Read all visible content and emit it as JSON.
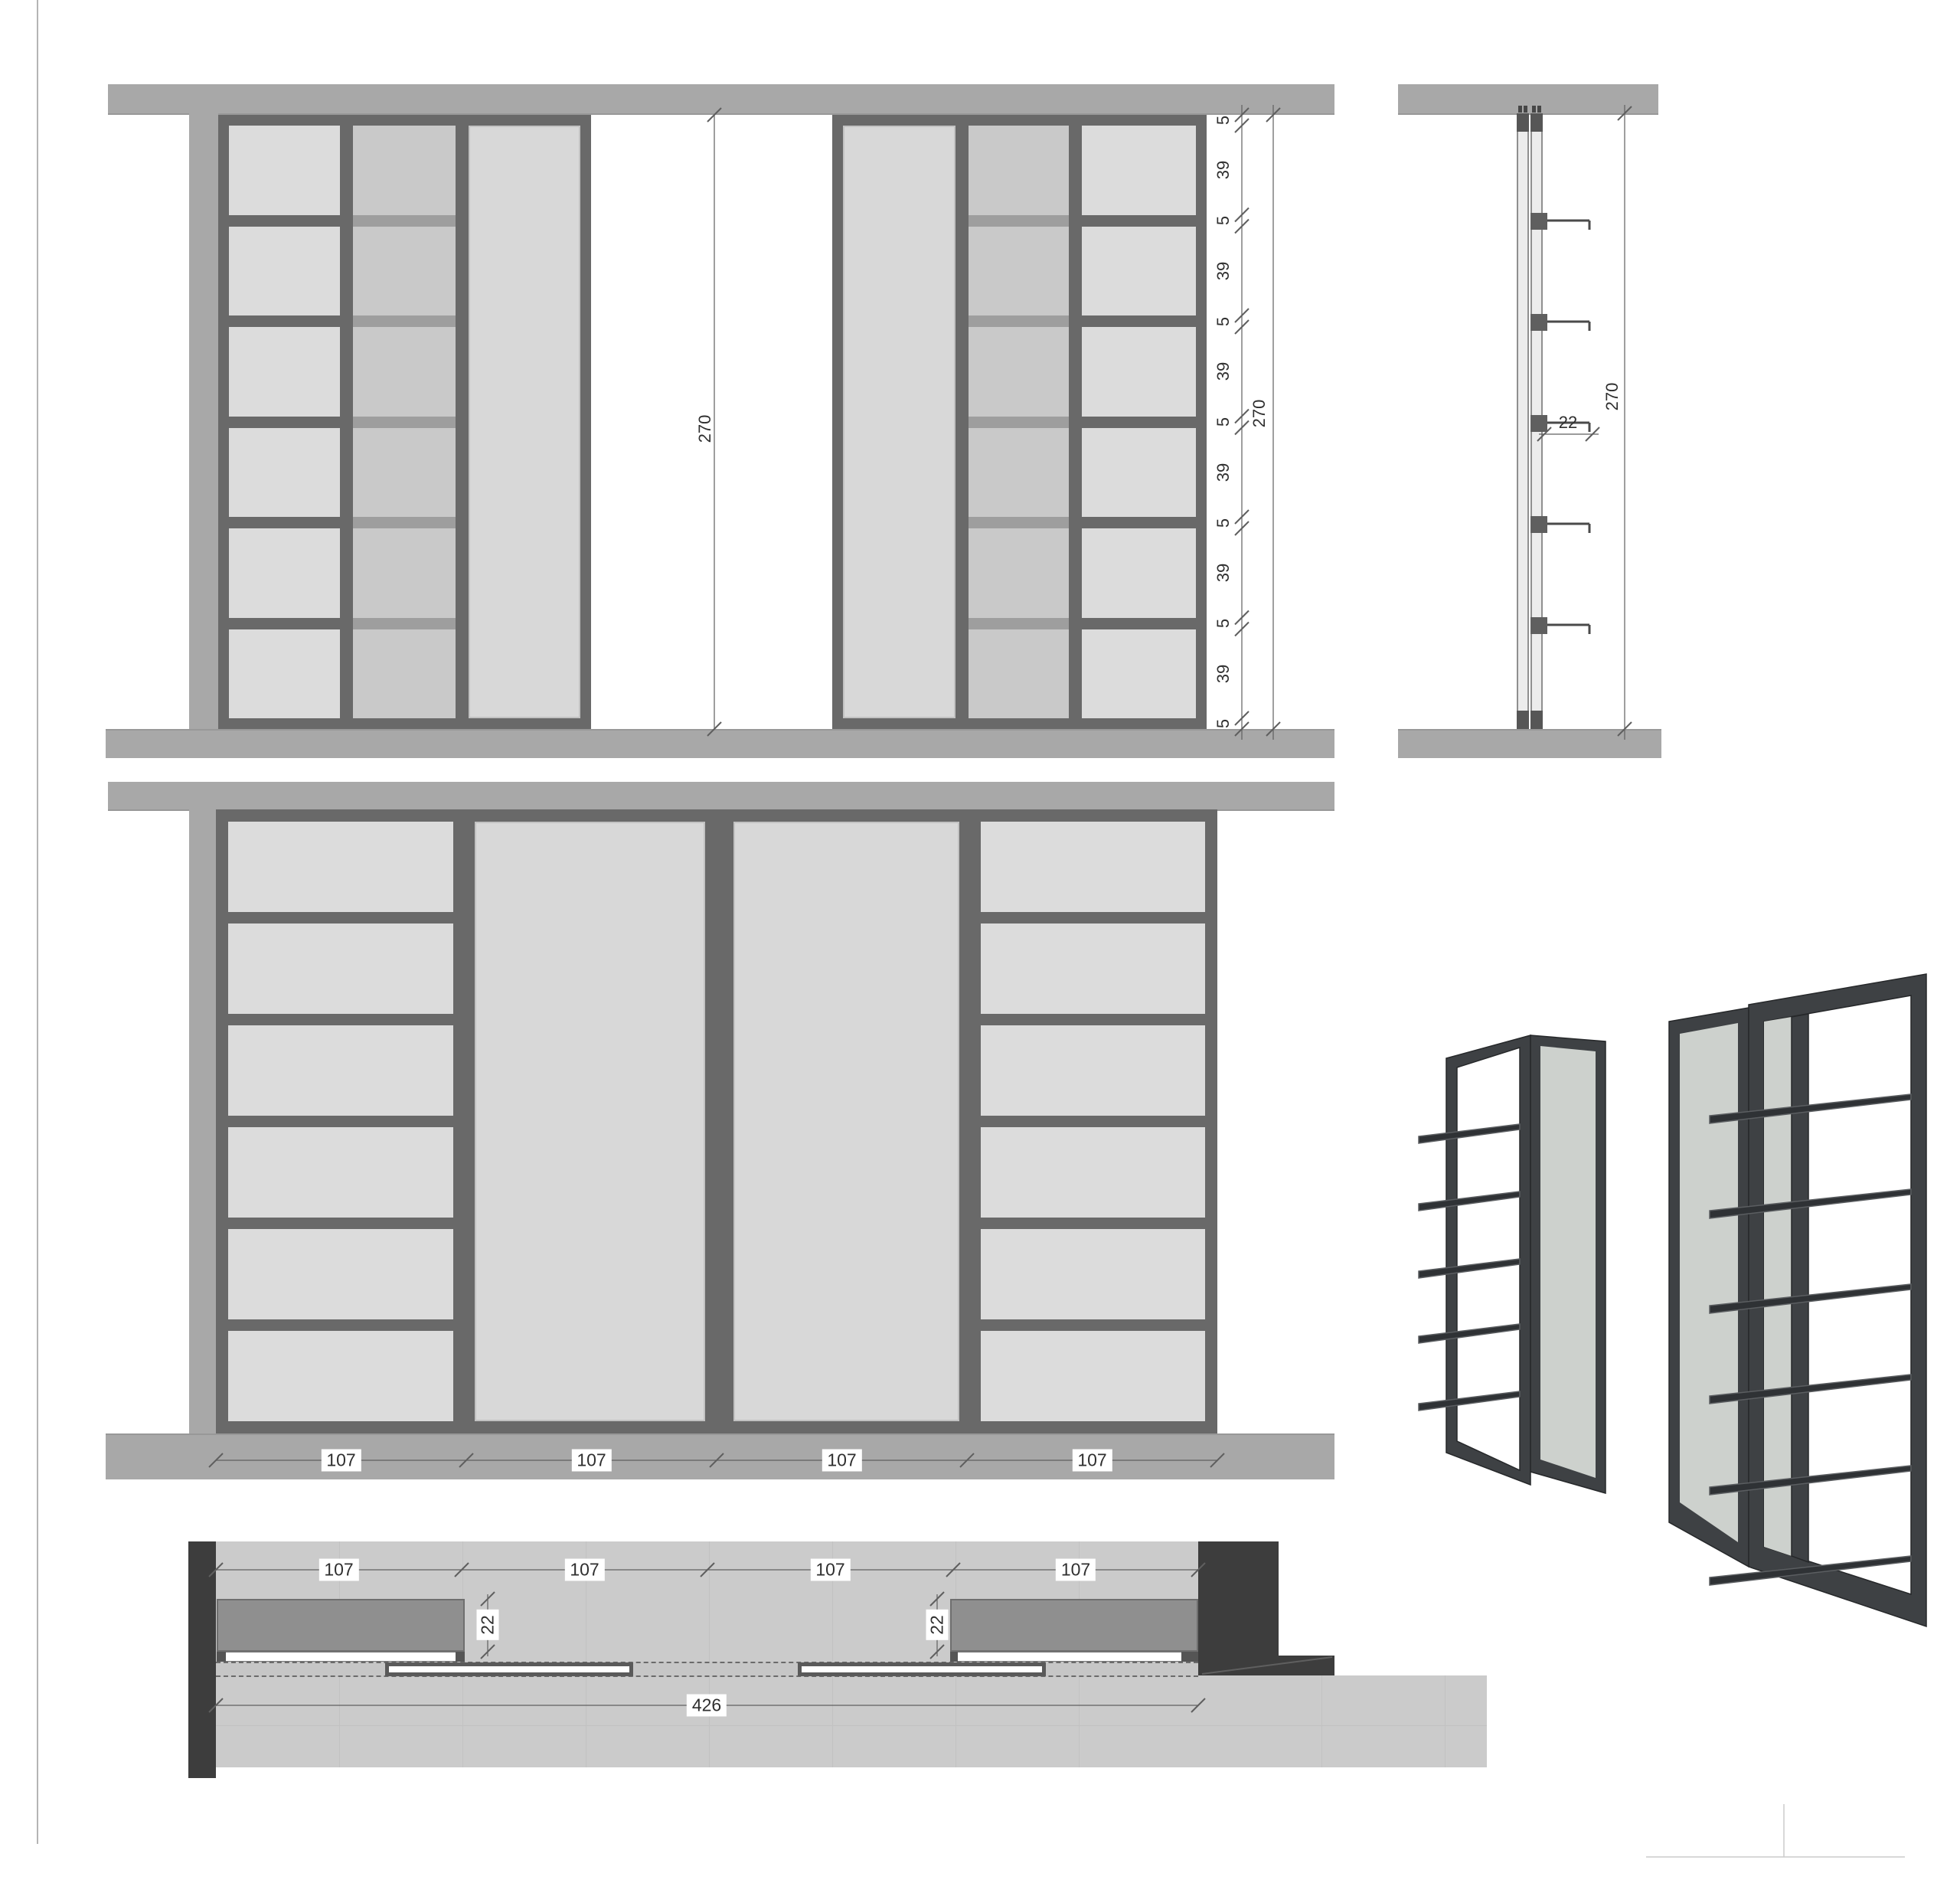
{
  "colors": {
    "background": "#ffffff",
    "wall_band": "#a8a8a8",
    "wall_band_edge": "#989898",
    "frame_dark": "#696969",
    "shelf_panel": "#dcdcdc",
    "shelf_panel_back": "#c9c9c9",
    "rail_back": "#9e9e9e",
    "glass_panel": "#d8d8d8",
    "side_rail_fill": "#ececec",
    "side_rail_edge": "#8f8f8f",
    "side_block": "#565656",
    "bracket": "#5f5f5f",
    "shelf_line": "#4a4a4a",
    "plan_wall_dark": "#3d3d3d",
    "plan_floor": "#cbcbcb",
    "plan_floor_seam": "#c2c2c2",
    "plan_unit": "#8f8f8f",
    "plan_unit_edge": "#6f6f6f",
    "plan_track": "#c6c6c6",
    "dim_line": "#5f5f5f",
    "dim_text": "#2f2f2f",
    "page_edge": "#b4b4b4",
    "render_frame": "#3e4144",
    "render_frame_edge": "#26282a",
    "render_glass": "#cdd1cd",
    "render_shelf": "#2f3235",
    "render_shelf_top": "#5b5e61"
  },
  "views": {
    "elevation_top": {
      "gap_dimension": "270",
      "height_chain": [
        "5",
        "39",
        "5",
        "39",
        "5",
        "39",
        "5",
        "39",
        "5",
        "39",
        "5",
        "39",
        "5"
      ],
      "total_height": "270"
    },
    "side_section": {
      "shelf_depth": "22",
      "total_height": "270"
    },
    "elevation_main": {
      "column_widths": [
        "107",
        "107",
        "107",
        "107"
      ]
    },
    "plan": {
      "column_widths": [
        "107",
        "107",
        "107",
        "107"
      ],
      "unit_depths": [
        "22",
        "22"
      ],
      "total_width": "426"
    }
  }
}
